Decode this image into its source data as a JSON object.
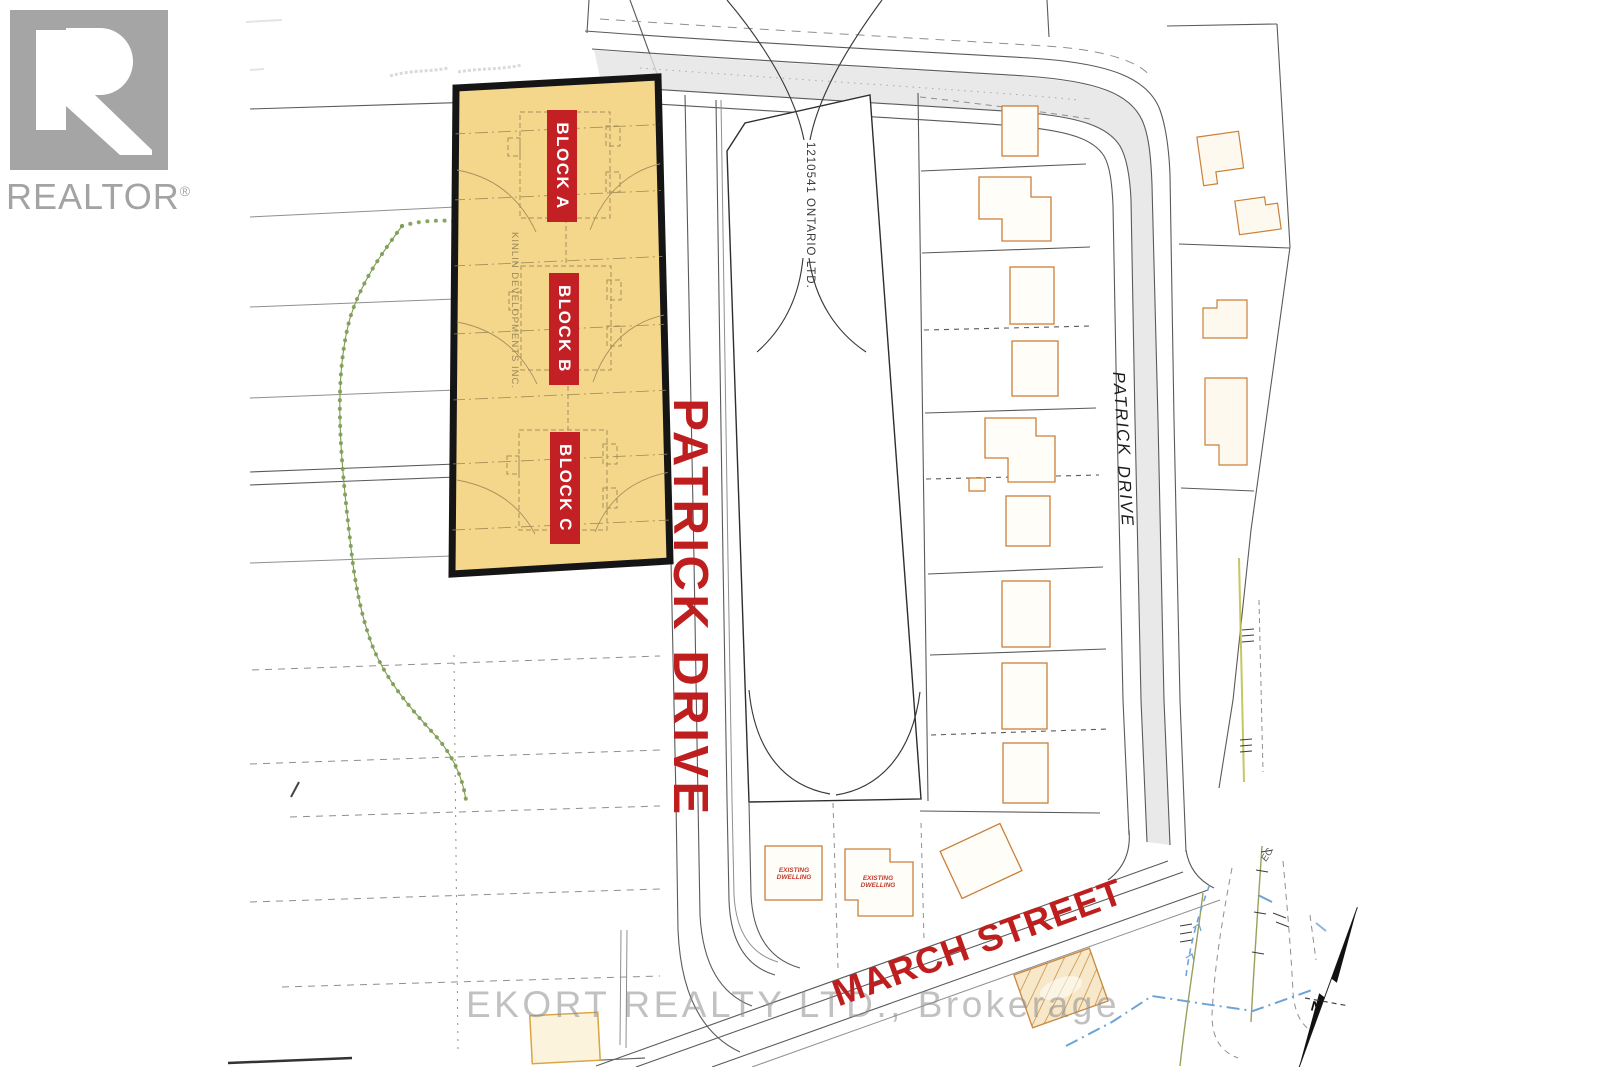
{
  "branding": {
    "realtor": "REALTOR",
    "registered": "®"
  },
  "watermark": {
    "text": "EKORT REALTY LTD., Brokerage"
  },
  "parcel": {
    "blocks": [
      {
        "label": "BLOCK A"
      },
      {
        "label": "BLOCK B"
      },
      {
        "label": "BLOCK C"
      }
    ],
    "developer": "KINLIN DEVELOPMENTS INC."
  },
  "labels": {
    "owner": "1210541 ONTARIO LTD.",
    "patrick_drive_main": "PATRICK DRIVE",
    "patrick_word": "PATRICK",
    "drive_word": "DRIVE",
    "march_street": "MARCH STREET",
    "existing_line1": "EXISTING",
    "existing_line2": "DWELLING",
    "north": "N",
    "survey_mark_ec": "EC"
  },
  "colors": {
    "parcel_fill": "#F5D78C",
    "parcel_border": "#151515",
    "block_badge": "#C32025",
    "street_red": "#BE1E1E",
    "house_outline": "#C9803B",
    "tree_green": "#7E9C52",
    "water_blue": "#6FA3D6",
    "road_gray": "#E4E4E4",
    "line_gray": "#5A5A5A",
    "watermark_gray": "#8F8F8F"
  }
}
